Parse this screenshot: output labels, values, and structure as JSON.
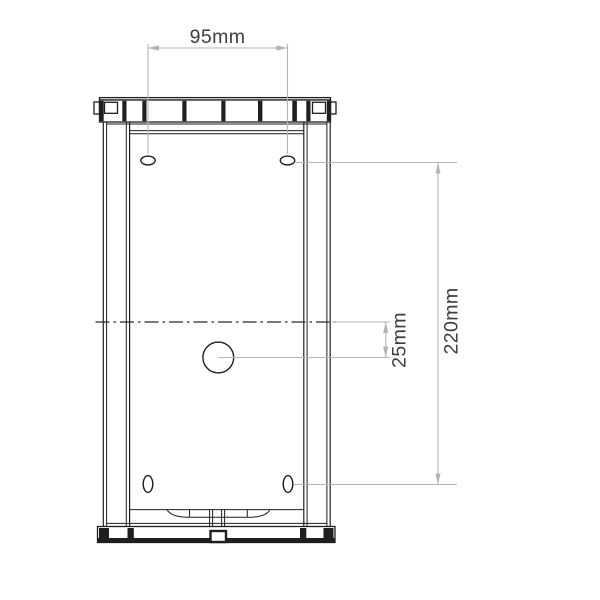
{
  "meta": {
    "description": "Technical line drawing: front elevation of a rectangular wall-fixture body with fixing-hole dimensions"
  },
  "dimensions": {
    "hole_spacing_width": "95mm",
    "hole_spacing_height": "220mm",
    "centre_offset": "25mm"
  },
  "colors": {
    "background": "#ffffff",
    "outline": "#1f1f1f",
    "dimension_line": "#b4b4b4",
    "dimension_text": "#3d3d3d"
  }
}
